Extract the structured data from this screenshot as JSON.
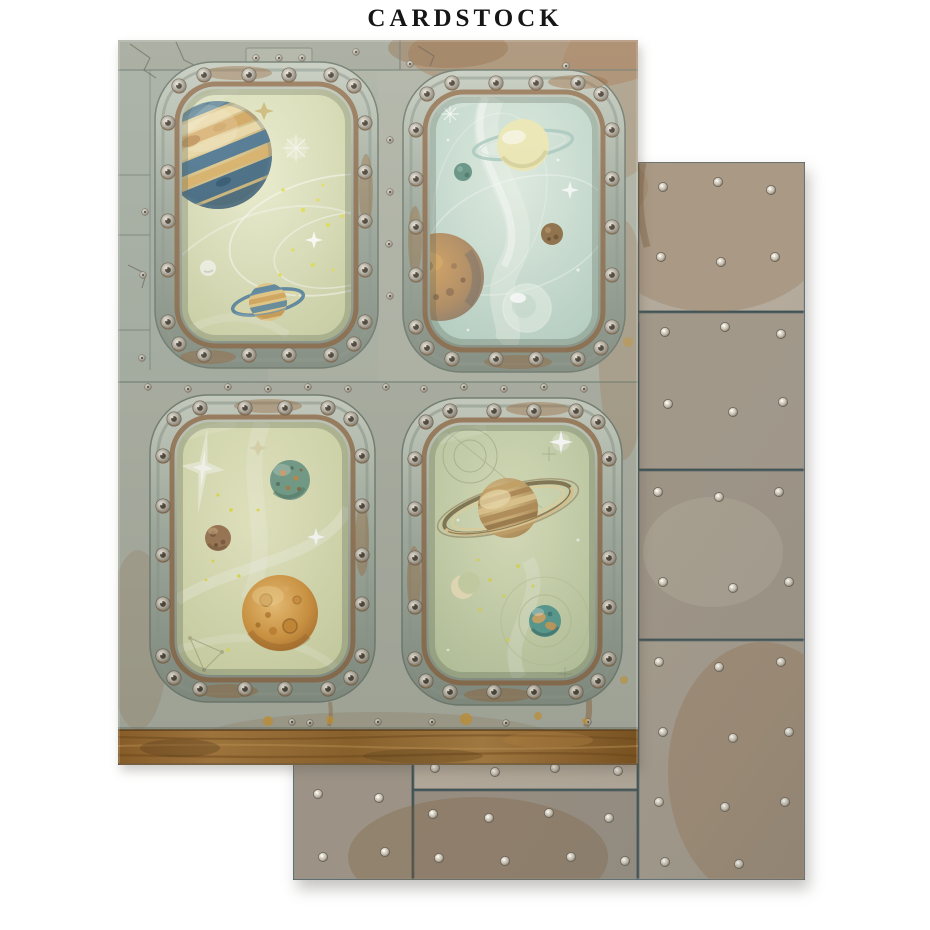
{
  "header": {
    "title": "CARDSTOCK"
  },
  "colors": {
    "background": "#ffffff",
    "front_sheet_metal": "#a9ada1",
    "back_sheet_metal": "#a19789",
    "frame_metal": "#a2ac9f",
    "seam_dark_teal": "#3c5054",
    "rust_strip": "#96662a",
    "rust_accent": "#8a5c32",
    "ochre_splatter": "#c79434",
    "scene_sage_green": "#d9dcb6",
    "scene_pale_aqua": "#cfe0d4",
    "planet_blue": "#44748f",
    "planet_gold": "#d9a85c",
    "rivet_silver": "#d8d2c6"
  }
}
